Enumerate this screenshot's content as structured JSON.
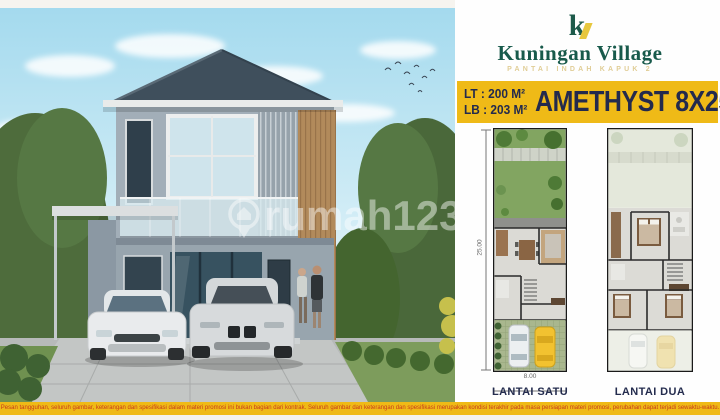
{
  "brand": {
    "logo_letter": "k",
    "name": "Kuningan Village",
    "tagline": "PANTAI INDAH KAPUK 2",
    "colors": {
      "green": "#185a4b",
      "logo_yellow": "#e7c73e"
    }
  },
  "banner": {
    "lt_label": "LT : 200 M²",
    "lb_label": "LB : 203 M²",
    "title": "AMETHYST 8X25",
    "colors": {
      "background": "#efba17",
      "text": "#232a4d"
    }
  },
  "plans": {
    "height_label": "25.00",
    "width_label": "8.00",
    "floor1_label": "LANTAI SATU",
    "floor2_label": "LANTAI DUA"
  },
  "photo": {
    "watermark": "rumah123"
  },
  "disclaimer": {
    "text": "Pesan tangguhan, seluruh gambar, keterangan dan spesifikasi dalam materi promosi ini bukan bagian dari kontrak. Seluruh gambar dan keterangan dan spesifikasi merupakan kondisi terakhir pada masa persiapan materi promosi, perubahan dapat terjadi sewaktu-waktu.",
    "colors": {
      "background": "#efba17",
      "text": "#c83a1c"
    }
  }
}
